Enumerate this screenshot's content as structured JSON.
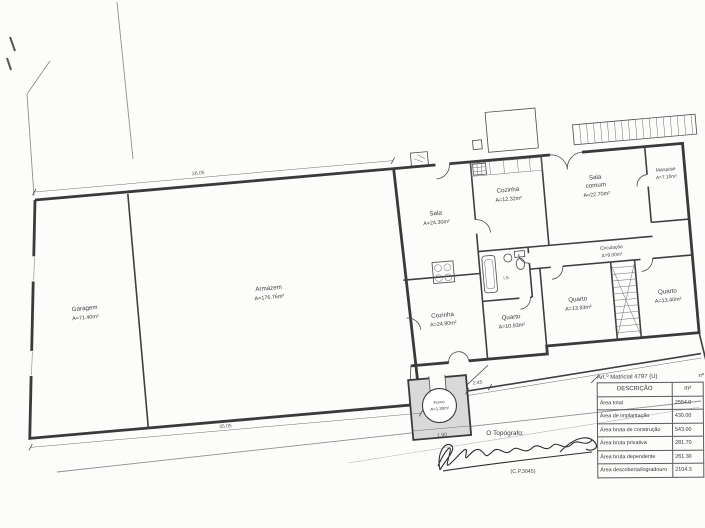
{
  "plan": {
    "rooms": {
      "garagem": {
        "name": "Garagem",
        "area": "A=71.40m²"
      },
      "armazem": {
        "name": "Armazem",
        "area": "A=176.76m²"
      },
      "sala": {
        "name": "Sala",
        "area": "A=24.30m²"
      },
      "cozinha": {
        "name": "Cozinha",
        "area": "A=12.32m²"
      },
      "sala_comum": {
        "line1": "Sala",
        "line2": "comum",
        "area": "A=22.70m²"
      },
      "marquise": {
        "name": "Marquise",
        "area": "A=7.10m²"
      },
      "circulacao": {
        "name": "Circulação",
        "area": "A=9.00m²"
      },
      "instalacao_sanitaria": {
        "name": "I.S."
      },
      "quarto_1": {
        "name": "Quarto",
        "area": "A=10.93m²"
      },
      "quarto_2": {
        "name": "Quarto",
        "area": "A=13.93m²"
      },
      "quarto_3": {
        "name": "Quarto",
        "area": "A=13.40m²"
      },
      "cozinha_2": {
        "name": "Cozinha",
        "area": "A=24.90m²"
      },
      "forno": {
        "name": "Forno",
        "area": "A=1.30m²"
      }
    },
    "dimensions": {
      "top_wall": "26.05",
      "bottom_wall": "35.05",
      "forno_width": "1.90",
      "forno_to_house": "2.45"
    }
  },
  "areas_table": {
    "title": "Art.º Matricial 4797 (U)",
    "corner_label": "nº",
    "col_descricao": "DESCRIÇÃO",
    "col_unit": "m²",
    "rows": [
      {
        "label": "Área total",
        "value": "2554.0"
      },
      {
        "label": "Área de implantação",
        "value": "430.00"
      },
      {
        "label": "Área bruta de construção",
        "value": "543.00"
      },
      {
        "label": "Área bruta privativa",
        "value": "281.70"
      },
      {
        "label": "Área bruta dependente",
        "value": "261.30"
      },
      {
        "label": "Área descoberta/logradouro",
        "value": "2104.3"
      }
    ]
  },
  "signature_block": {
    "title": "O Topógrafo:",
    "credential": "(C.P.3045)"
  },
  "colors": {
    "ink": "#3a3a3a",
    "paper": "#fcfcfb",
    "forno_fill": "#d9d9d9"
  }
}
